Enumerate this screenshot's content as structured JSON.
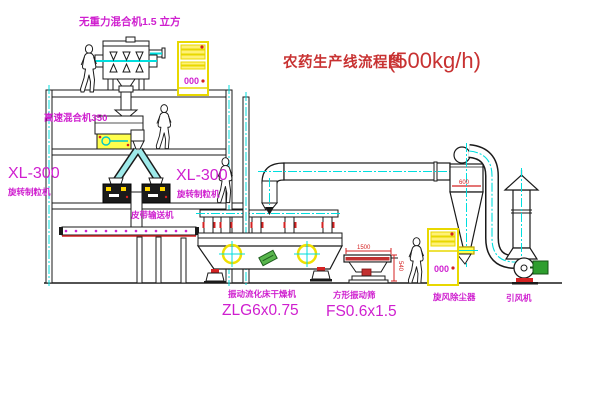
{
  "title": {
    "name": "农药生产线流程图",
    "capacity": "(500kg/h)"
  },
  "equipment_labels": {
    "gravity_mixer": "无重力混合机1.5 立方",
    "high_speed_mixer": "高速混合机350",
    "granulator_left_model": "XL-300",
    "granulator_left_name": "旋转制粒机",
    "granulator_right_model": "XL-300",
    "granulator_right_name": "旋转制粒机",
    "belt_conveyor": "皮带输送机",
    "dryer_name": "振动流化床干燥机",
    "dryer_model": "ZLG6x0.75",
    "screen_name": "方形振动筛",
    "screen_model": "FS0.6x1.5",
    "cyclone": "旋风除尘器",
    "induced_fan": "引风机"
  },
  "dimensions": {
    "cyclone_diameter": "600",
    "screen_length": "1500",
    "screen_height": "540"
  },
  "control_panels": {
    "upper_display": "000",
    "lower_display": "000"
  },
  "colors": {
    "label_magenta": "#cf1fcf",
    "title_red": "#c83232",
    "centerline_cyan": "#00dede",
    "highlight_yellow": "#fff100",
    "dim_red": "#d42222"
  }
}
